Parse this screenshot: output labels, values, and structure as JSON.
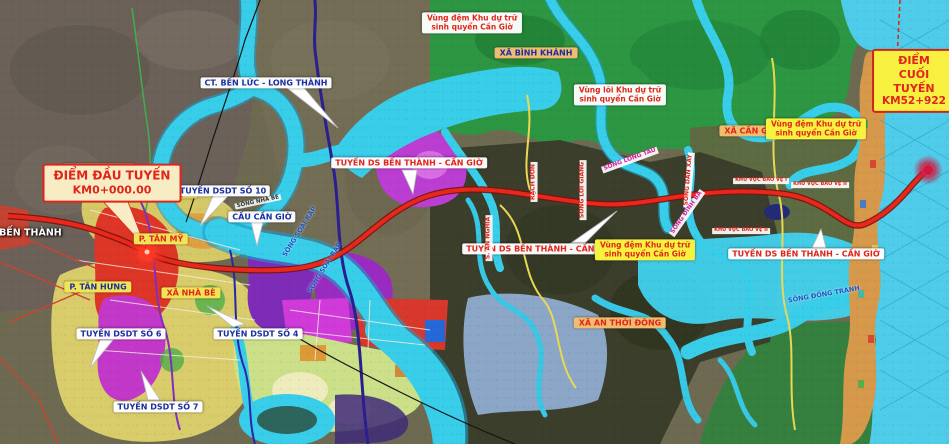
{
  "map": {
    "description": "Planning map of the Ben Thanh - Can Gio railway route over land-use zones",
    "colors": {
      "railway_red": "#e8281c",
      "water_cyan": "#38cde9",
      "mangrove_green": "#2c9642",
      "planning_yellow": "#d9cc6b",
      "label_red": "#e0251b",
      "label_blue": "#1a2fa0",
      "sea_cyan": "#4fcce9",
      "town_orange": "#d6994c"
    },
    "endpoints": {
      "start": {
        "line1": "ĐIỂM ĐẦU TUYẾN",
        "line2": "KM0+000.00"
      },
      "end": {
        "line1": "ĐIỂM CUỐI TUYẾN",
        "line2": "KM52+922"
      }
    },
    "labels": [
      {
        "name": "label-p-ben-thanh",
        "text": "P.BẾN THÀNH",
        "x": 26,
        "y": 234,
        "style": "zone-white-text"
      },
      {
        "name": "label-p-tan-thuan",
        "text": "P. TÂN THUẬN",
        "x": 99,
        "y": 169,
        "style": "ward-tan-blue"
      },
      {
        "name": "label-p-phu-thuan",
        "text": "P. PHÚ THUẬN",
        "x": 160,
        "y": 193,
        "style": "ward-yellow-blue"
      },
      {
        "name": "label-p-tan-my",
        "text": "P. TÂN MỸ",
        "x": 161,
        "y": 239,
        "style": "ward-yellow-red"
      },
      {
        "name": "label-p-tan-hung",
        "text": "P. TÂN HƯNG",
        "x": 98,
        "y": 287,
        "style": "ward-yellow-blue"
      },
      {
        "name": "label-xa-nha-be",
        "text": "XÃ NHÀ BÈ",
        "x": 191,
        "y": 293,
        "style": "ward-yellow-red"
      },
      {
        "name": "label-xa-binh-khanh",
        "text": "XÃ BÌNH KHÁNH",
        "x": 536,
        "y": 53,
        "style": "ward-tan-blue"
      },
      {
        "name": "label-xa-can-gio",
        "text": "XÃ CẦN GIỜ",
        "x": 751,
        "y": 131,
        "style": "ward-tan-red"
      },
      {
        "name": "label-xa-an-thoi-dong",
        "text": "XÃ AN THỚI ĐÔNG",
        "x": 620,
        "y": 323,
        "style": "ward-tan-red"
      },
      {
        "name": "label-ct-ben-luc-long-thanh",
        "text": "CT. BẾN LỨC - LONG THÀNH",
        "x": 266,
        "y": 83,
        "style": "callout-blue"
      },
      {
        "name": "label-tuyen-dsdt-so-10",
        "text": "TUYẾN DSDT SỐ 10",
        "x": 223,
        "y": 191,
        "style": "callout-blue"
      },
      {
        "name": "label-cau-can-gio",
        "text": "CẦU CẦN GIỜ",
        "x": 262,
        "y": 217,
        "style": "callout-blue"
      },
      {
        "name": "label-tuyen-dsdt-so-6",
        "text": "TUYẾN DSDT SỐ 6",
        "x": 121,
        "y": 334,
        "style": "callout-blue"
      },
      {
        "name": "label-tuyen-dsdt-so-4",
        "text": "TUYẾN DSDT SỐ 4",
        "x": 258,
        "y": 334,
        "style": "callout-blue"
      },
      {
        "name": "label-tuyen-dsdt-so-7",
        "text": "TUYẾN DSDT SỐ 7",
        "x": 158,
        "y": 407,
        "style": "callout-blue"
      },
      {
        "name": "label-tuyen-ds-bt-cg-1",
        "text": "TUYẾN DS BẾN THÀNH - CẦN GIỜ",
        "x": 409,
        "y": 163,
        "style": "callout-red"
      },
      {
        "name": "label-tuyen-ds-bt-cg-2",
        "text": "TUYẾN DS BẾN THÀNH - CẦN GIỜ",
        "x": 540,
        "y": 249,
        "style": "callout-red"
      },
      {
        "name": "label-tuyen-ds-bt-cg-3",
        "text": "TUYẾN DS BẾN THÀNH - CẦN GIỜ",
        "x": 806,
        "y": 254,
        "style": "callout-red"
      },
      {
        "name": "label-vung-dem-1",
        "lines": [
          "Vùng đệm Khu dự trữ",
          "sinh quyển Cần Giờ"
        ],
        "x": 472,
        "y": 23,
        "style": "buffer-white"
      },
      {
        "name": "label-vung-loi",
        "lines": [
          "Vùng lõi Khu dự trữ",
          "sinh quyển Cần Giờ"
        ],
        "x": 620,
        "y": 95,
        "style": "buffer-white"
      },
      {
        "name": "label-vung-dem-2",
        "lines": [
          "Vùng đệm Khu dự trữ",
          "sinh quyển Cần Giờ"
        ],
        "x": 816,
        "y": 129,
        "style": "buffer-yellow"
      },
      {
        "name": "label-vung-dem-3",
        "lines": [
          "Vùng đệm Khu dự trữ",
          "sinh quyển Cần Giờ"
        ],
        "x": 645,
        "y": 250,
        "style": "buffer-yellow"
      },
      {
        "name": "label-khu-vuc-bao-ve-1",
        "text": "KHU VỰC BẢO VỆ I",
        "x": 761,
        "y": 181,
        "style": "protect"
      },
      {
        "name": "label-khu-vuc-bao-ve-2a",
        "text": "KHU VỰC BẢO VỆ II",
        "x": 820,
        "y": 185,
        "style": "protect"
      },
      {
        "name": "label-khu-vuc-bao-ve-2b",
        "text": "KHU VỰC BẢO VỆ II",
        "x": 741,
        "y": 231,
        "style": "protect"
      },
      {
        "name": "label-song-nha-be",
        "text": "SÔNG NHÀ BÈ",
        "x": 258,
        "y": 202,
        "style": "river-dark",
        "rot": -12
      },
      {
        "name": "label-song-soai-rap-1",
        "text": "SÔNG SOÀI RẠP",
        "x": 300,
        "y": 232,
        "style": "river-blue",
        "rot": -58
      },
      {
        "name": "label-song-soai-rap-2",
        "text": "SÔNG SOÀI RẠP",
        "x": 325,
        "y": 268,
        "style": "river-blue",
        "rot": -58
      },
      {
        "name": "label-s-an-nghia",
        "text": "S. AN NGHĨA",
        "x": 489,
        "y": 238,
        "style": "river-red-box",
        "rot": -90
      },
      {
        "name": "label-rach-don",
        "text": "RẠCH ĐÔN",
        "x": 534,
        "y": 182,
        "style": "river-red-box",
        "rot": -90
      },
      {
        "name": "label-song-loi-giang",
        "text": "SÔNG LÔI GIANG",
        "x": 583,
        "y": 190,
        "style": "river-red-box",
        "rot": -90
      },
      {
        "name": "label-song-long-tau",
        "text": "SÔNG LÒNG TÀU",
        "x": 630,
        "y": 160,
        "style": "river-magenta-box",
        "rot": -20
      },
      {
        "name": "label-song-dan-xay",
        "text": "SÔNG DẦN XÂY",
        "x": 689,
        "y": 180,
        "style": "river-red-box",
        "rot": -85
      },
      {
        "name": "label-song-dinh-ba",
        "text": "SÔNG ĐINH BÀ",
        "x": 687,
        "y": 213,
        "style": "river-magenta-box",
        "rot": -55
      },
      {
        "name": "label-song-dong-tranh",
        "text": "SÔNG ĐỒNG TRANH",
        "x": 824,
        "y": 295,
        "style": "river-blue",
        "rot": -10
      }
    ]
  }
}
